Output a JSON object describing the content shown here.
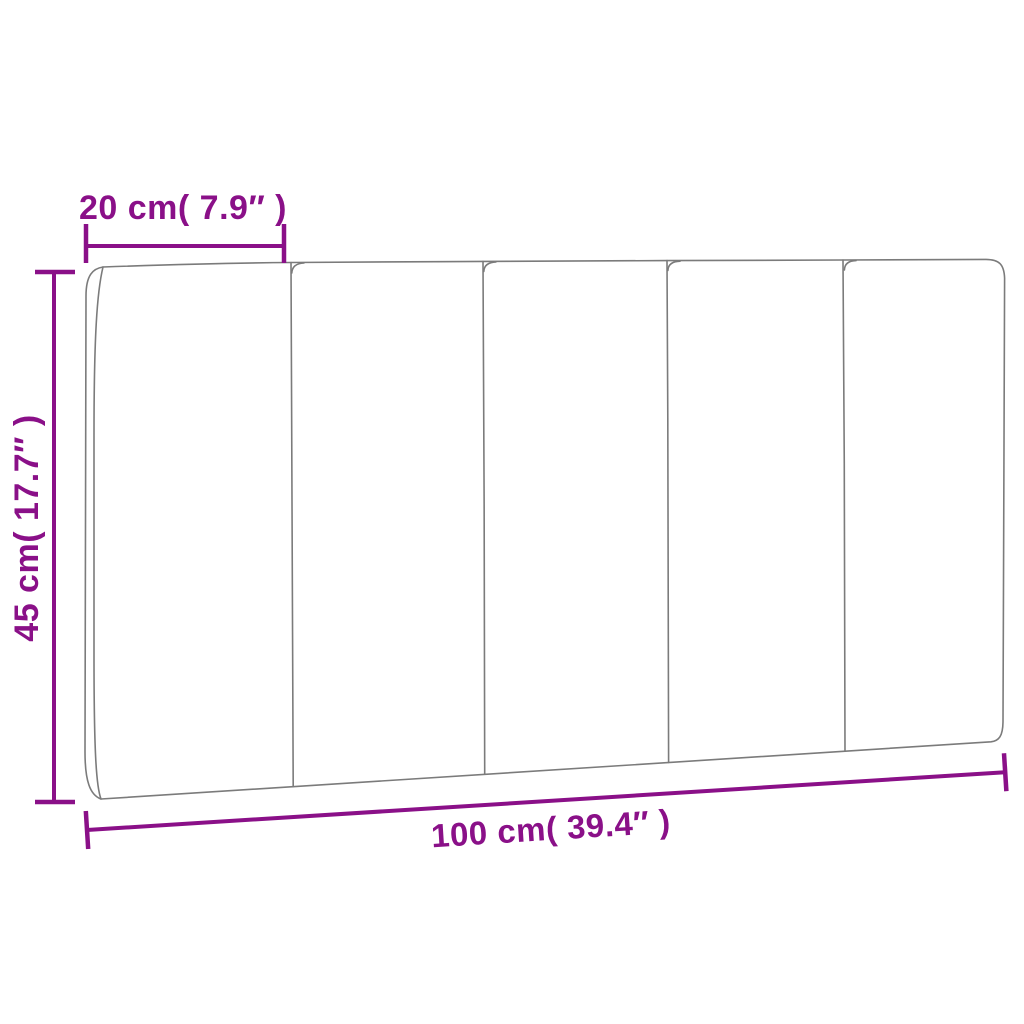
{
  "diagram": {
    "kind": "product-dimension-diagram",
    "object": {
      "description": "upholstered headboard cushion drawn in outline, 5 vertical panels, slight perspective",
      "panel_count": 5
    },
    "annotations": {
      "panel_width": {
        "label": "20 cm( 7.9″ )",
        "cm": 20,
        "inches": 7.9,
        "position": "top-left"
      },
      "height": {
        "label": "45 cm( 17.7″ )",
        "cm": 45,
        "inches": 17.7,
        "position": "left"
      },
      "total_width": {
        "label": "100 cm( 39.4″ )",
        "cm": 100,
        "inches": 39.4,
        "position": "bottom"
      }
    },
    "colors": {
      "dimension_accent": "#8a1088",
      "outline_gray": "#7b7b7b",
      "background": "#ffffff"
    }
  }
}
